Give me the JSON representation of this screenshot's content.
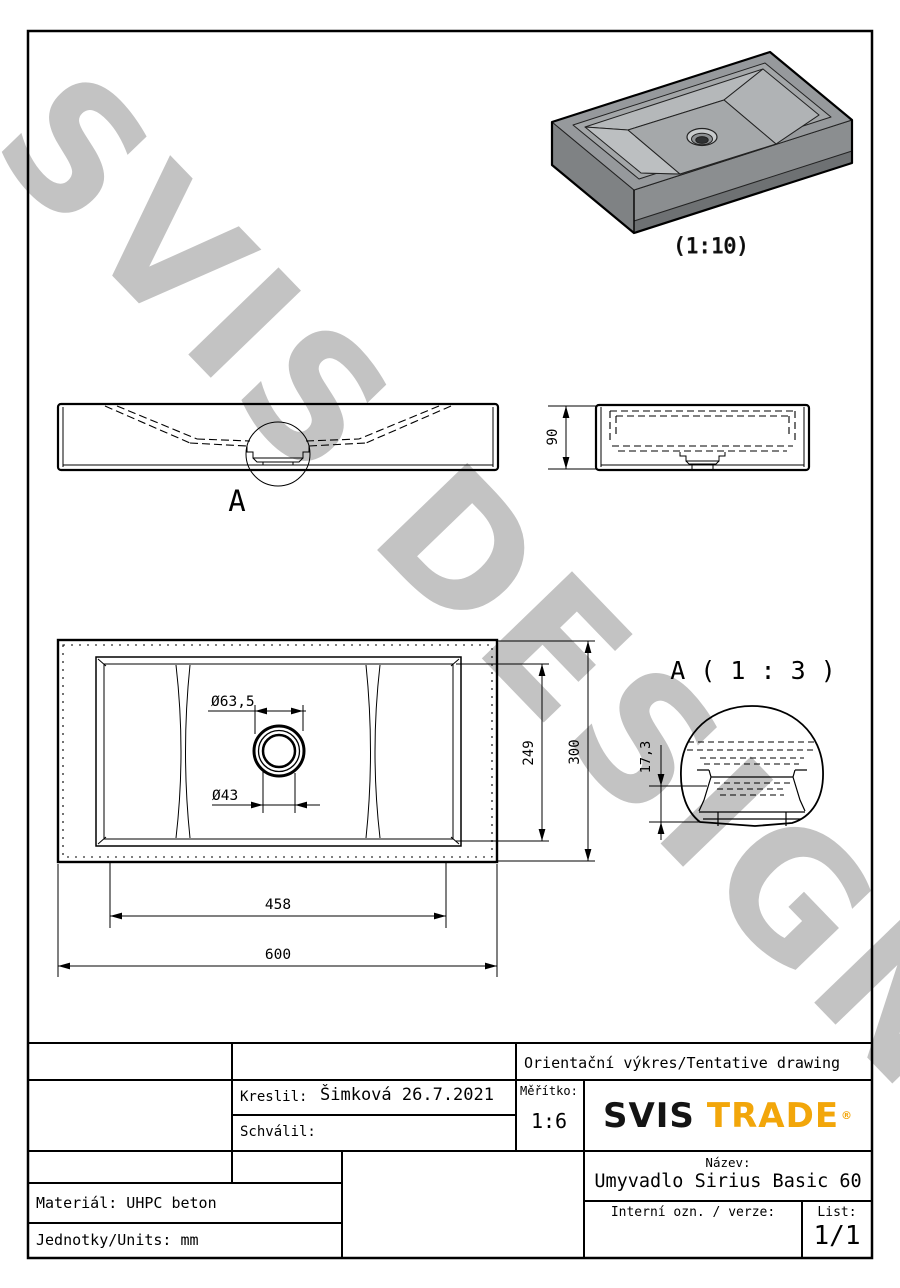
{
  "watermark": {
    "text": "SVIS DESIGN"
  },
  "views": {
    "iso": {
      "scale_label": "(1:10)"
    },
    "front": {
      "detail_marker": "A"
    },
    "side": {
      "dim_height": "90"
    },
    "plan": {
      "dim_drain_outer": "Ø63,5",
      "dim_drain_inner": "Ø43",
      "dim_inner_width": "249",
      "dim_width": "300",
      "dim_inner_length": "458",
      "dim_length": "600"
    },
    "detail": {
      "title": "A ( 1 : 3 )",
      "dim_depth": "17,3"
    }
  },
  "title_block": {
    "tentative_note": "Orientační výkres/Tentative drawing",
    "drawn_by_label": "Kreslil:",
    "drawn_by_value": "Šimková 26.7.2021",
    "approved_by_label": "Schválil:",
    "scale_label": "Měřítko:",
    "scale_value": "1:6",
    "logo_primary": "SVIS",
    "logo_secondary": "TRADE",
    "logo_reg": "®",
    "title_label": "Název:",
    "title_value": "Umyvadlo Sirius Basic 60",
    "internal_label": "Interní ozn. / verze:",
    "sheet_label": "List:",
    "sheet_value": "1/1",
    "material_note": "Materiál: UHPC beton",
    "units_note": "Jednotky/Units: mm"
  },
  "colors": {
    "accent": "#F2A60A",
    "line": "#000000",
    "watermark": "#c3c3c3"
  }
}
